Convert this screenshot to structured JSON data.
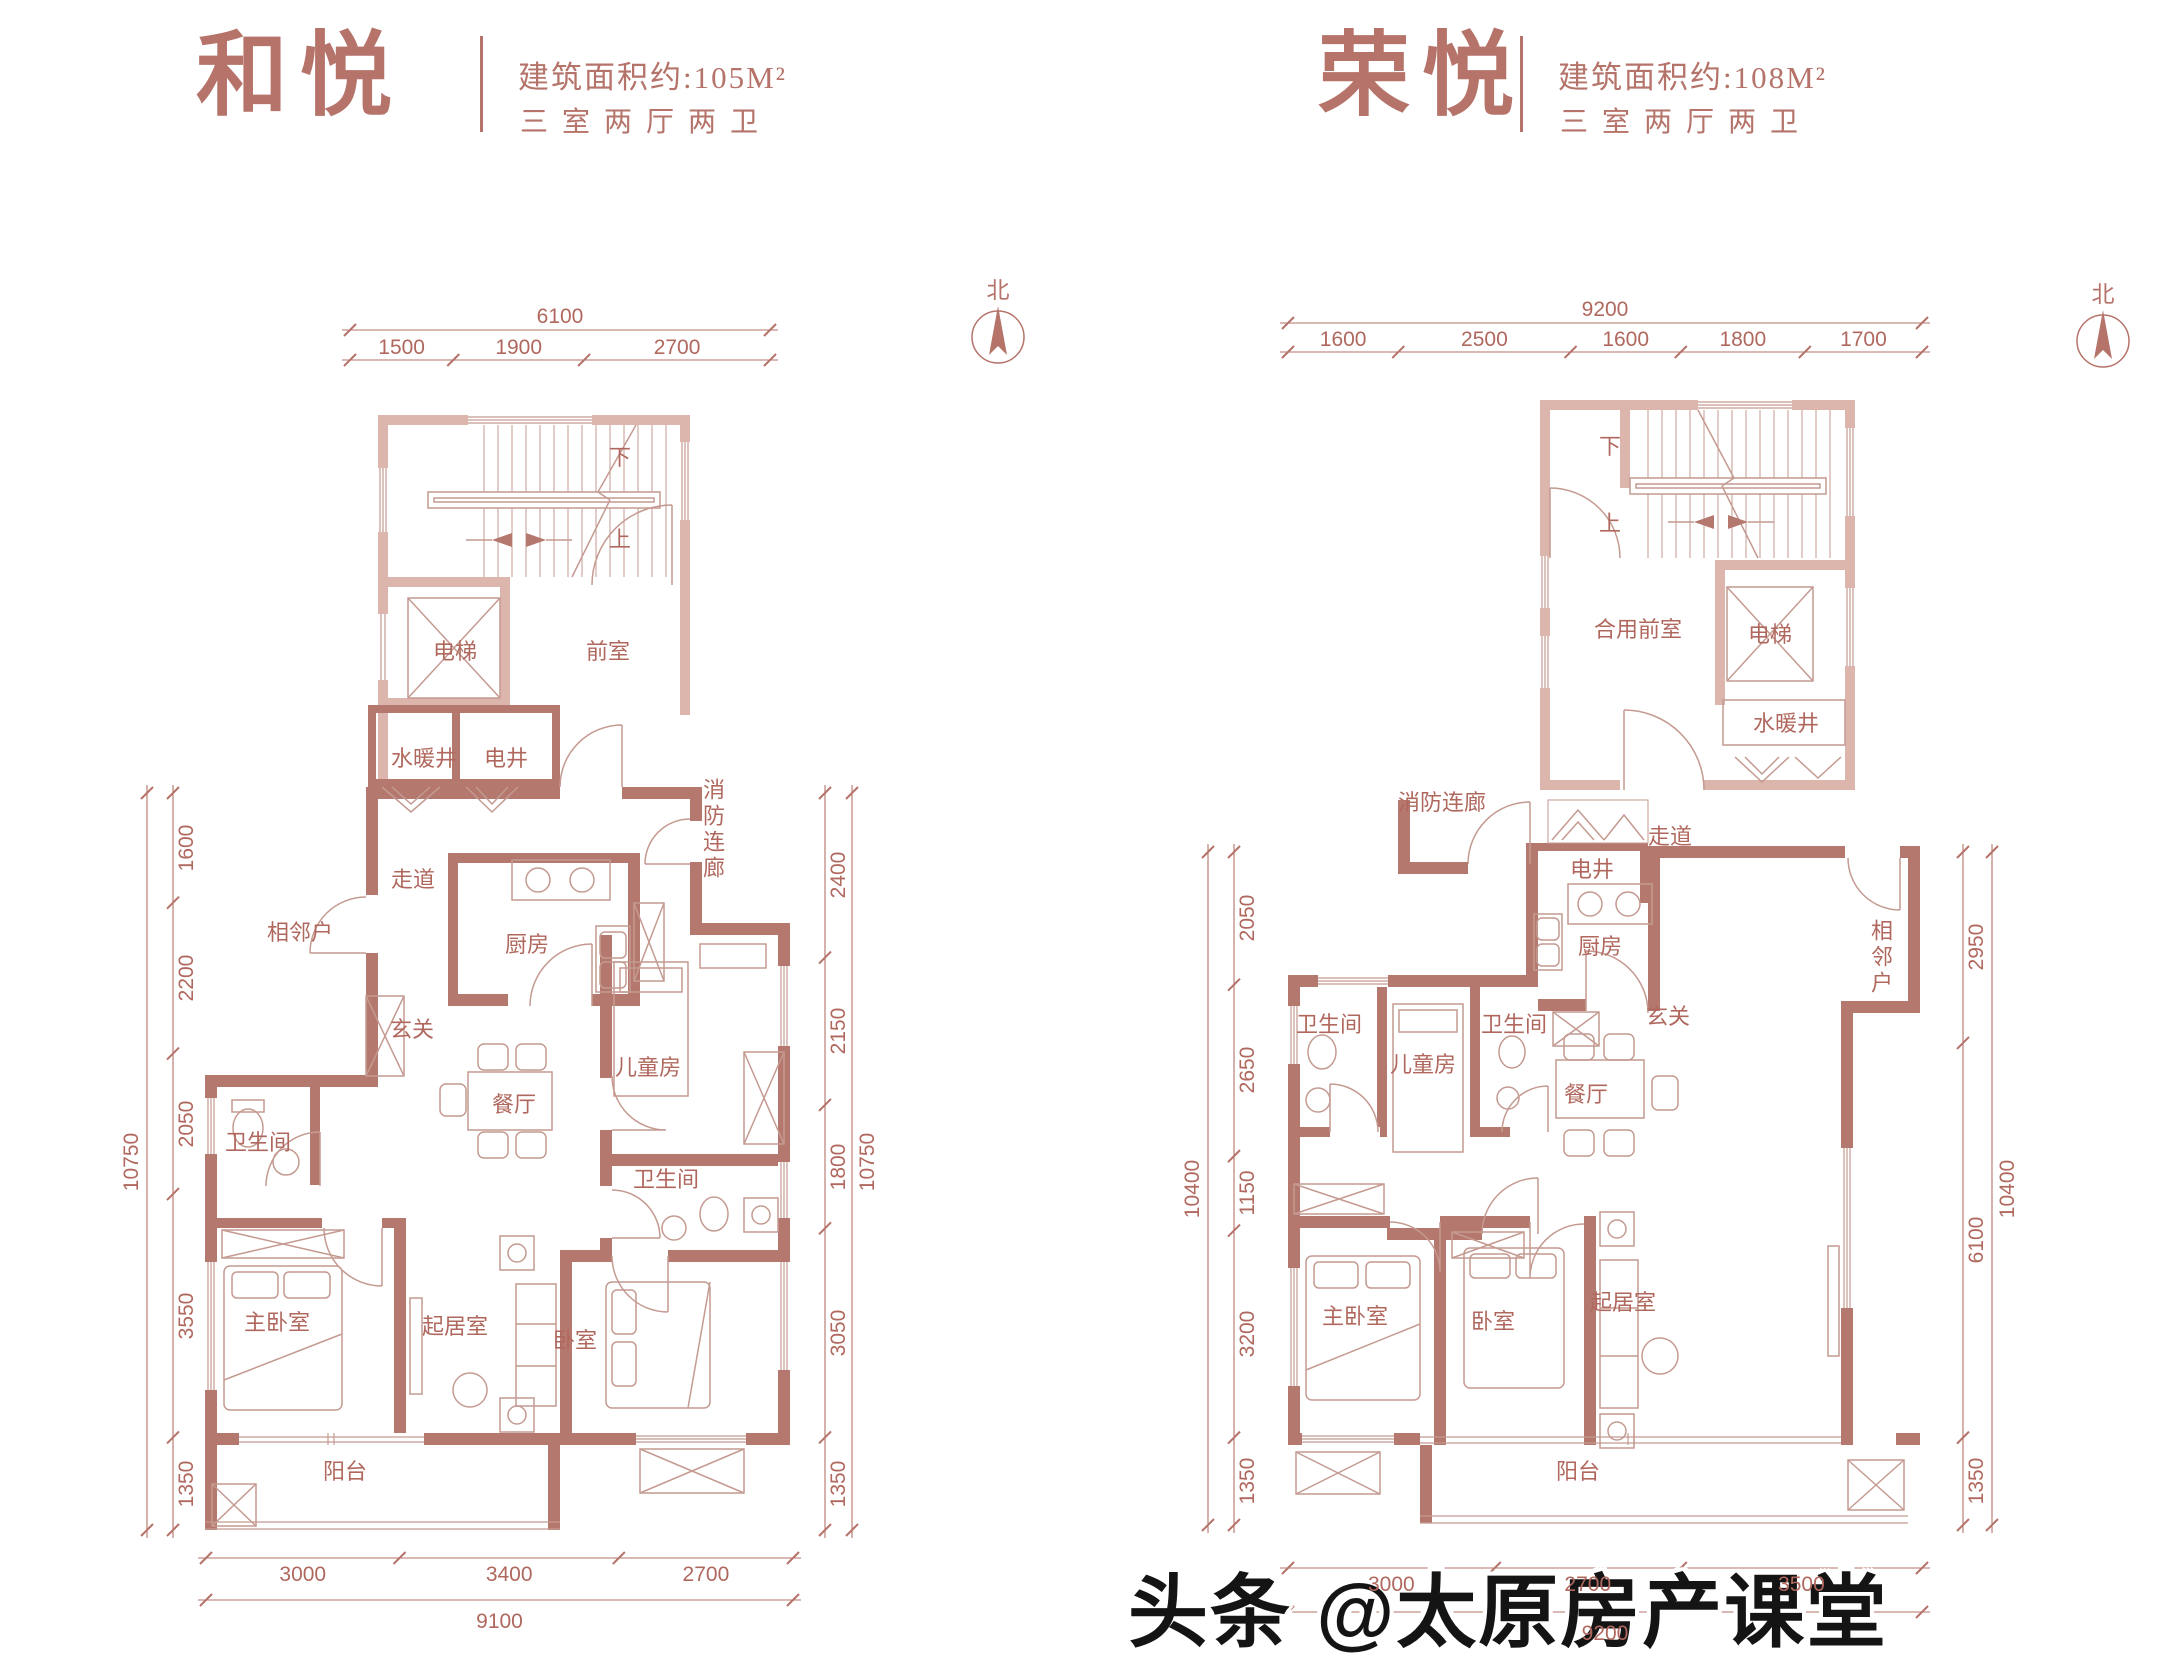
{
  "page": {
    "watermark": "头条 @太原房产课堂",
    "north_label": "北"
  },
  "colors": {
    "accent": "#b5736a",
    "wall_deep": "#b5786e",
    "wall_light": "#dcb5ac",
    "linework": "#c49a91"
  },
  "plans": [
    {
      "title": "和悦",
      "area": "建筑面积约:105M²",
      "layout": "三室两厅两卫",
      "stairs": {
        "down": "下",
        "up": "上"
      },
      "rooms": {
        "elevator": "电梯",
        "front_room": "前室",
        "water_shaft": "水暖井",
        "electric_shaft": "电井",
        "fire_corridor": "消防连廊",
        "corridor": "走道",
        "neighbor": "相邻户",
        "foyer": "玄关",
        "kitchen": "厨房",
        "kids_room": "儿童房",
        "dining": "餐厅",
        "bathroom_1": "卫生间",
        "bathroom_2": "卫生间",
        "master_bedroom": "主卧室",
        "living_room": "起居室",
        "bedroom": "卧室",
        "balcony": "阳台"
      },
      "dims": {
        "top": {
          "total": "6100",
          "segments": [
            "1500",
            "1900",
            "2700"
          ]
        },
        "left": {
          "total": "10750",
          "segments": [
            "1600",
            "2200",
            "2050",
            "3550",
            "1350"
          ]
        },
        "right": {
          "total": "10750",
          "segments": [
            "2400",
            "2150",
            "1800",
            "3050",
            "1350"
          ]
        },
        "bottom": {
          "total": "9100",
          "segments": [
            "3000",
            "3400",
            "2700"
          ]
        }
      }
    },
    {
      "title": "荣悦",
      "area": "建筑面积约:108M²",
      "layout": "三室两厅两卫",
      "stairs": {
        "down": "下",
        "up": "上"
      },
      "rooms": {
        "shared_front_room": "合用前室",
        "elevator": "电梯",
        "water_shaft": "水暖井",
        "fire_corridor": "消防连廊",
        "electric_shaft": "电井",
        "corridor": "走道",
        "kitchen": "厨房",
        "neighbor": "相邻户",
        "foyer": "玄关",
        "bathroom_1": "卫生间",
        "bathroom_2": "卫生间",
        "kids_room": "儿童房",
        "dining": "餐厅",
        "master_bedroom": "主卧室",
        "bedroom": "卧室",
        "living_room": "起居室",
        "balcony": "阳台"
      },
      "dims": {
        "top": {
          "total": "9200",
          "segments": [
            "1600",
            "2500",
            "1600",
            "1800",
            "1700"
          ]
        },
        "left": {
          "total": "10400",
          "segments": [
            "2050",
            "2650",
            "1150",
            "3200",
            "1350"
          ]
        },
        "right": {
          "total": "10400",
          "segments": [
            "2950",
            "6100",
            "1350"
          ]
        },
        "bottom": {
          "total": "9200",
          "segments": [
            "3000",
            "2700",
            "3500"
          ]
        }
      }
    }
  ]
}
